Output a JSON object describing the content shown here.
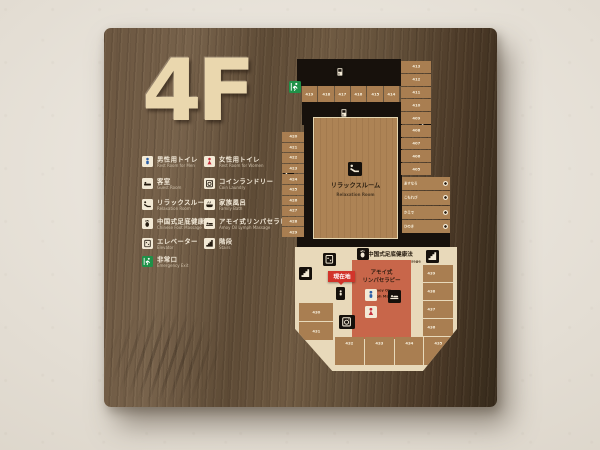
{
  "floor": {
    "label": "4F"
  },
  "legend": {
    "col1": [
      {
        "icon": "mens-toilet",
        "ja": "男性用トイレ",
        "en": "Rest Room for Men"
      },
      {
        "icon": "guest-room",
        "ja": "客室",
        "en": "Guest Room"
      },
      {
        "icon": "relaxation",
        "ja": "リラックスルーム",
        "en": "Relaxation Room"
      },
      {
        "icon": "foot-massage",
        "ja": "中国式足底健康法",
        "en": "Chinese Foot Massage"
      },
      {
        "icon": "elevator",
        "ja": "エレベーター",
        "en": "Elevator"
      },
      {
        "icon": "emergency-exit",
        "ja": "非常口",
        "en": "Emergency Exit"
      }
    ],
    "col2": [
      {
        "icon": "womens-toilet",
        "ja": "女性用トイレ",
        "en": "Rest Room for Women"
      },
      {
        "icon": "coin-laundry",
        "ja": "コインランドリー",
        "en": "Coin Laundry"
      },
      {
        "icon": "family-bath",
        "ja": "家族風呂",
        "en": "Family Bath"
      },
      {
        "icon": "lymph-massage",
        "ja": "アモイ式リンパセラピー",
        "en": "Amoy Oil Lymph Massage"
      },
      {
        "icon": "stairs",
        "ja": "階段",
        "en": "Stairs"
      }
    ]
  },
  "map": {
    "current_location": "現在地",
    "relaxation_room": {
      "ja": "リラックスルーム",
      "en": "Relaxation Room"
    },
    "chinese_foot_massage": {
      "ja": "中国式足底健康法",
      "en": "Chinese Foot Massage"
    },
    "lymph_massage": {
      "ja1": "アモイ式",
      "ja2": "リンパセラピー",
      "en1": "Amoy Oil",
      "en2": "Lymph Massage"
    },
    "rooms": {
      "top_row": [
        "419",
        "418",
        "417",
        "416",
        "415",
        "414"
      ],
      "right_column": [
        "413",
        "412",
        "411",
        "410",
        "409",
        "408",
        "407",
        "406",
        "405"
      ],
      "left_column": [
        "420",
        "421",
        "422",
        "423",
        "424",
        "425",
        "426",
        "427",
        "428",
        "429"
      ],
      "bottom_left_column": [
        "430",
        "431"
      ],
      "bottom_row": [
        "432",
        "433",
        "434",
        "435"
      ],
      "bottom_right_column": [
        "439",
        "438",
        "437",
        "436"
      ],
      "family_baths": [
        "あすなろ",
        "こもれび",
        "かえで",
        "ひのき"
      ]
    }
  },
  "colors": {
    "wall": "#ebe5db",
    "board_wood": "#65503a",
    "floor_letters": "#ead7ae",
    "room_block": "#a97e51",
    "floor_light": "#e8d9ba",
    "corridor_black": "#17110c",
    "lymph_red_area": "#c8664a",
    "current_location_red": "#d2342a",
    "mens_blue": "#2c5fa8",
    "womens_red": "#c5303c",
    "exit_green": "#1f9148"
  }
}
